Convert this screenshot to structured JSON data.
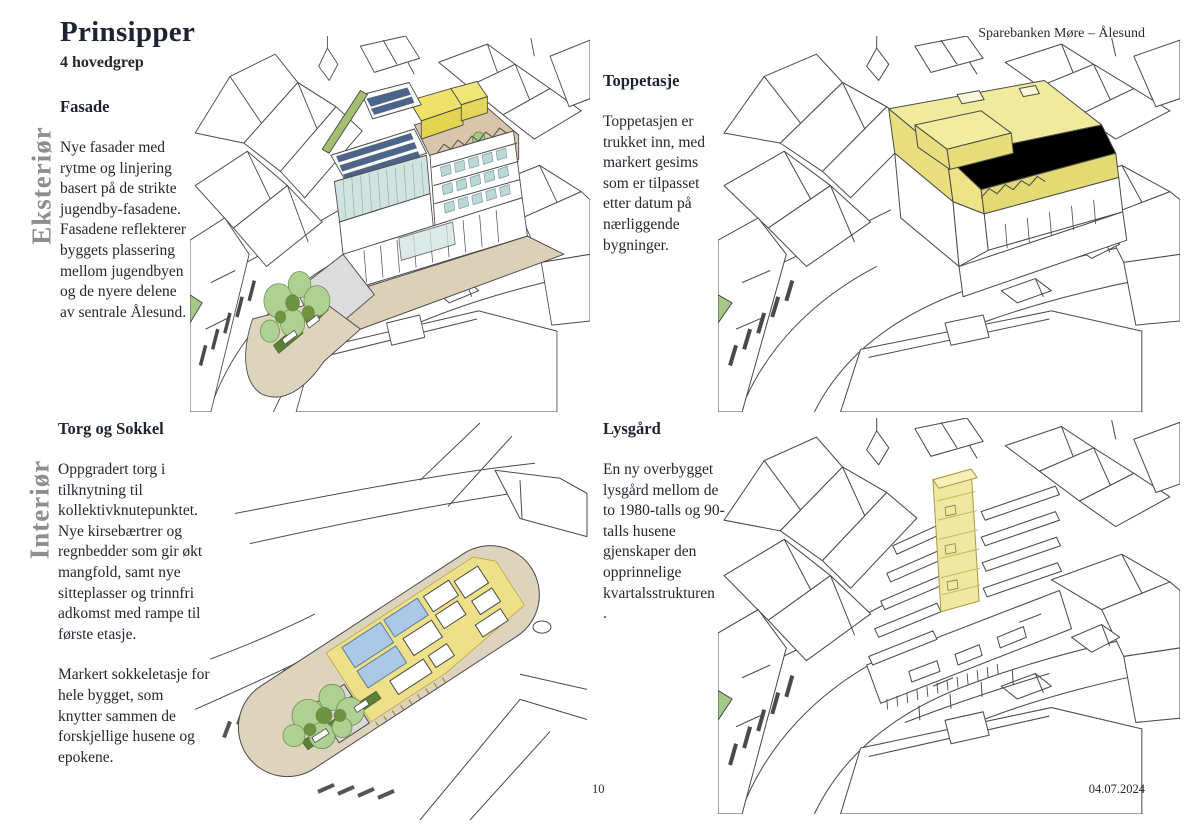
{
  "page": {
    "title": "Prinsipper",
    "subtitle": "4 hovedgrep",
    "brand": "Sparebanken Møre – Ålesund"
  },
  "side_labels": {
    "top": "Eksteriør",
    "bottom": "Interiør"
  },
  "sections": [
    {
      "id": "fasade",
      "heading": "Fasade",
      "paragraphs": [
        "Nye fasader med rytme og linjering basert på de strikte jugendby-fasadene. Fasadene reflekterer byggets plassering mellom jugendbyen og de nyere delene av sentrale Ålesund."
      ],
      "illustration_alt": "aerial-sketch-of-block-with-new-facades-solar-roof-and-trees"
    },
    {
      "id": "toppetasje",
      "heading": "Toppetasje",
      "paragraphs": [
        "Toppetasjen er trukket inn, med markert gesims som er tilpasset etter datum på nærliggende bygninger."
      ],
      "illustration_alt": "aerial-sketch-with-top-floor-highlighted-yellow"
    },
    {
      "id": "torg-og-sokkel",
      "heading": "Torg og Sokkel",
      "paragraphs": [
        "Oppgradert torg i tilknytning til kollektivknutepunktet. Nye kirsebærtrer og regnbedder som gir økt mangfold, samt nye sitteplasser og trinnfri adkomst med rampe til første etasje.",
        "Markert sokkeletasje for hele bygget, som knytter sammen de forskjellige husene og epokene."
      ],
      "illustration_alt": "aerial-plan-sketch-with-yellow-plinth-deck-trees-and-square"
    },
    {
      "id": "lysgard",
      "heading": "Lysgård",
      "paragraphs": [
        "En ny overbygget lysgård mellom de to 1980-talls og 90-talls husene gjenskaper den opprinnelige kvartalsstrukturen",
        "."
      ],
      "illustration_alt": "cutaway-sketch-with-yellow-lightwell-shaft"
    }
  ],
  "footer": {
    "page_number": "10",
    "date": "04.07.2024"
  },
  "colors": {
    "highlight_yellow": "#f0ea9d",
    "deck_yellow": "#ede088",
    "solar_blue": "#4d648a",
    "roof_blue": "#abc8e4",
    "glass_teal": "#cfe3df",
    "tree_green": "#aed093",
    "dark_green": "#5d8136",
    "ground_beige": "#ded3bd",
    "terrace_tan": "#d8c5aa",
    "line_ink": "#4a4a4a",
    "text": "#26262e",
    "label_gray": "#8e8e8e"
  }
}
